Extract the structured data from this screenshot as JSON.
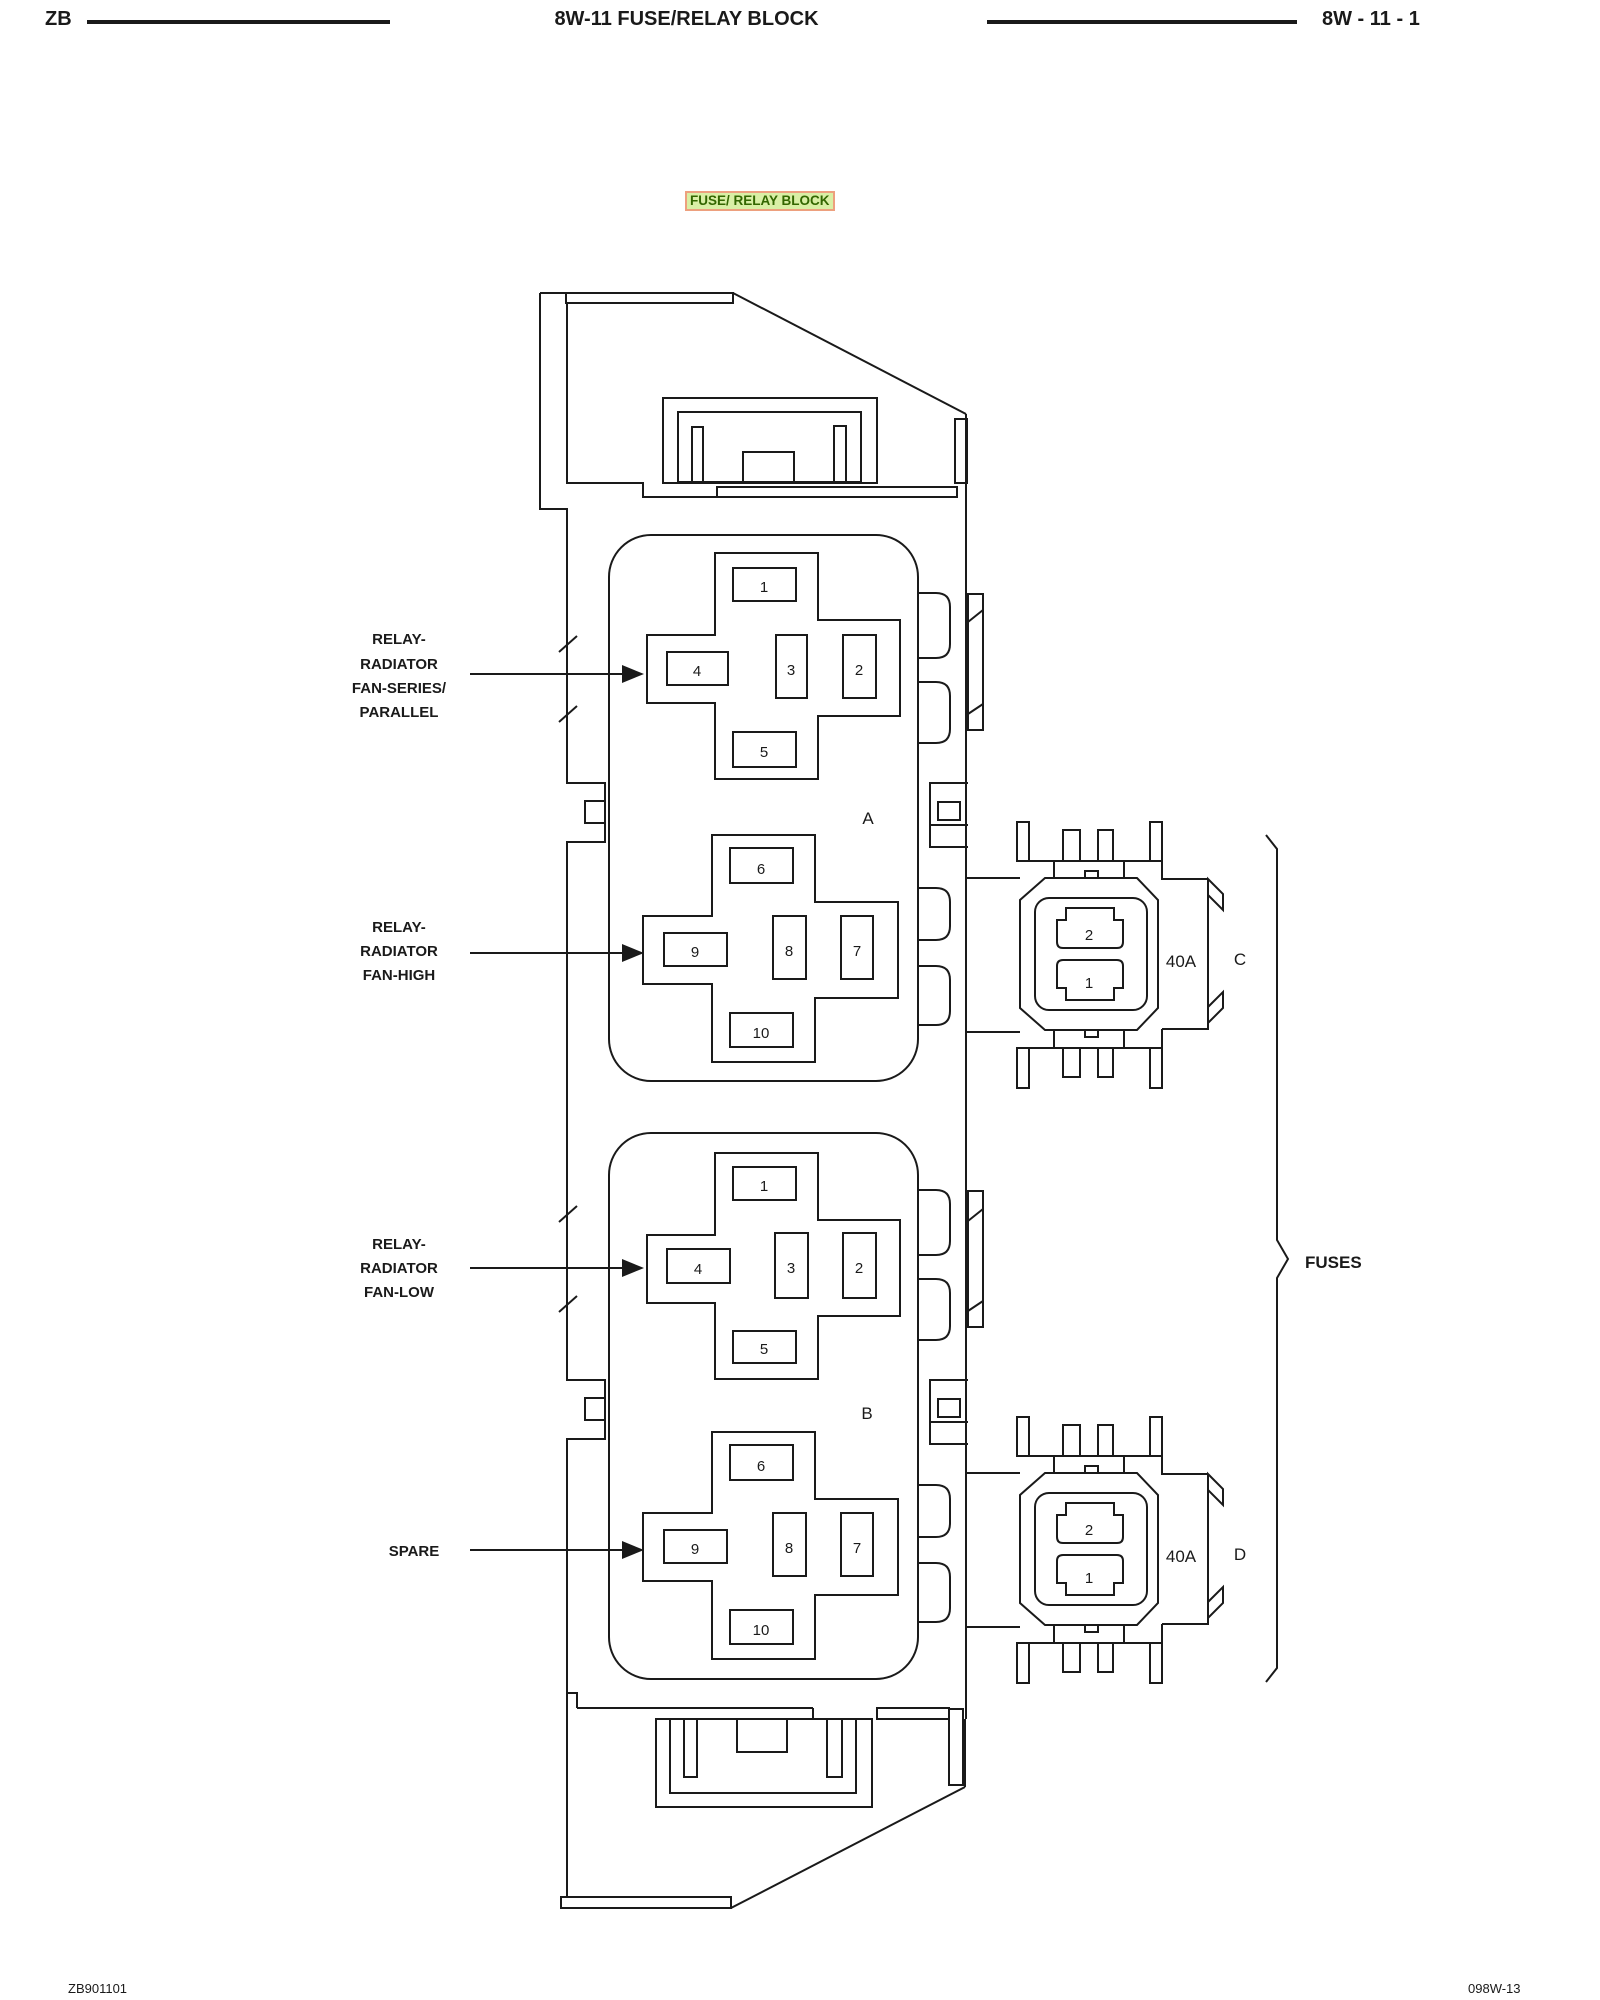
{
  "header": {
    "code": "ZB",
    "title": "8W-11 FUSE/RELAY BLOCK",
    "page": "8W - 11 - 1"
  },
  "figure_title": "FUSE/ RELAY BLOCK",
  "callouts": {
    "relay_series_parallel": {
      "lines": [
        "RELAY-",
        "RADIATOR",
        "FAN-SERIES/",
        "PARALLEL"
      ]
    },
    "relay_fan_high": {
      "lines": [
        "RELAY-",
        "RADIATOR",
        "FAN-HIGH"
      ]
    },
    "relay_fan_low": {
      "lines": [
        "RELAY-",
        "RADIATOR",
        "FAN-LOW"
      ]
    },
    "spare": {
      "label": "SPARE"
    },
    "fuses": {
      "label": "FUSES"
    }
  },
  "connectors": [
    {
      "id": "A",
      "top_cavities": [
        "1",
        "4",
        "3",
        "2",
        "5"
      ],
      "bottom_cavities": [
        "6",
        "9",
        "8",
        "7",
        "10"
      ]
    },
    {
      "id": "B",
      "top_cavities": [
        "1",
        "4",
        "3",
        "2",
        "5"
      ],
      "bottom_cavities": [
        "6",
        "9",
        "8",
        "7",
        "10"
      ]
    }
  ],
  "fuses": [
    {
      "id": "C",
      "rating": "40A",
      "cavities": [
        "2",
        "1"
      ]
    },
    {
      "id": "D",
      "rating": "40A",
      "cavities": [
        "2",
        "1"
      ]
    }
  ],
  "footer": {
    "left": "ZB901101",
    "right": "098W-13"
  },
  "colors": {
    "line": "#1a1a1a",
    "highlight_bg": "#d9efa5",
    "highlight_border": "#eda07e",
    "highlight_text": "#336600"
  }
}
